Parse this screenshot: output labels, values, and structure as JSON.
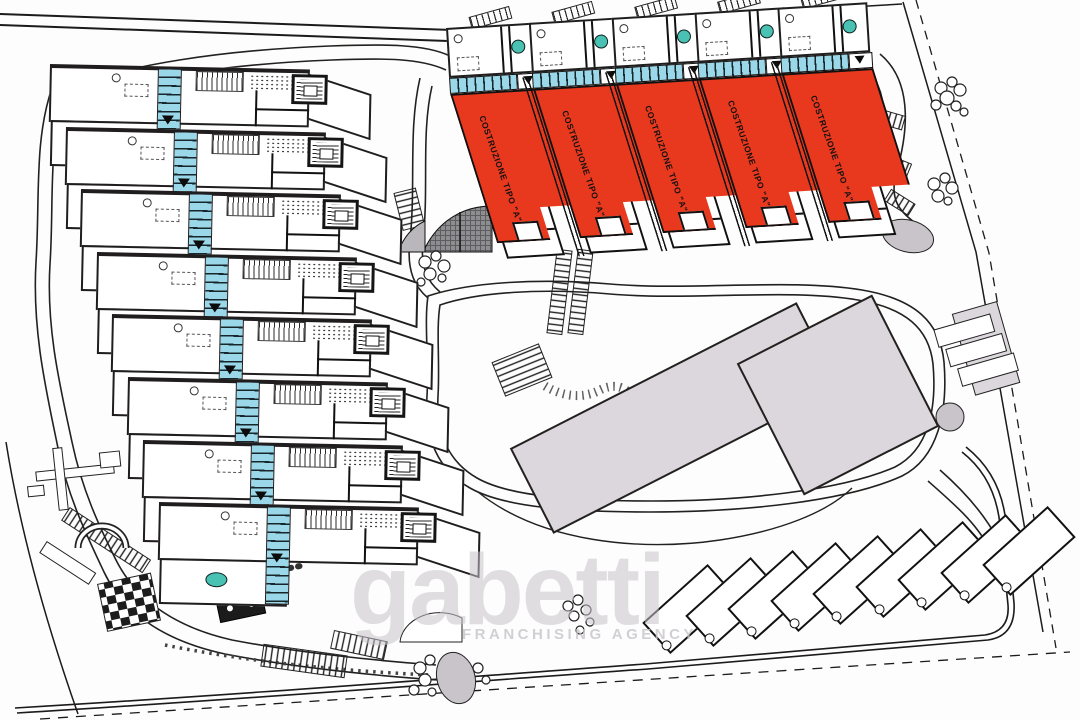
{
  "plan": {
    "kind": "residential site plan drawing",
    "buildings": [
      {
        "label": "COSTRUZIONE TIPO \"A\""
      },
      {
        "label": "COSTRUZIONE TIPO \"A\""
      },
      {
        "label": "COSTRUZIONE TIPO \"A\""
      },
      {
        "label": "COSTRUZIONE TIPO \"A\""
      },
      {
        "label": "COSTRUZIONE TIPO \"A\""
      }
    ],
    "left_units": [
      1,
      2,
      3,
      4,
      5,
      6,
      7,
      8
    ],
    "parking": [
      1,
      2,
      3,
      4,
      5,
      6,
      7,
      8,
      9
    ],
    "watermark": {
      "brand": "gabetti",
      "subtitle": "FRANCHISING AGENCY"
    }
  },
  "colors": {
    "ink": "#1f1d1e",
    "red": "#E8391F",
    "blue": "#9AD7E8",
    "teal": "#49C2B4",
    "gray_building": "#DCD7DC",
    "gray_oval": "#C8C4CA",
    "gray_fan": "#8E8E92",
    "watermark": "#C7C4CA",
    "paper": "#FDFDFD"
  }
}
